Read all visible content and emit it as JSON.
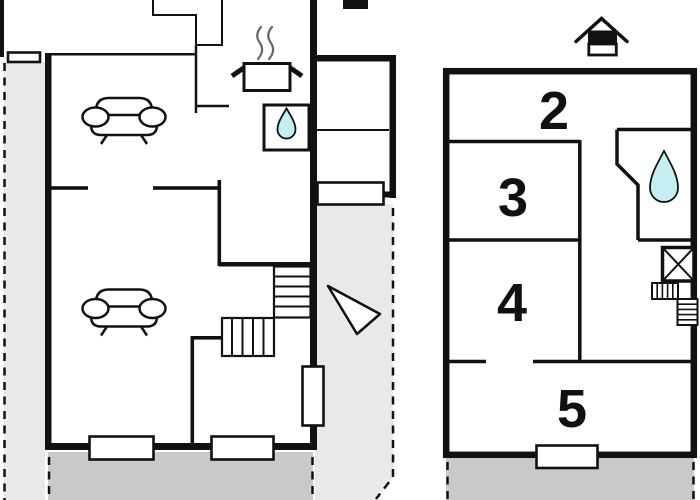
{
  "title": "Two-storey holiday home floor plan",
  "colors": {
    "wall": "#111111",
    "terrace_light": "#e9e9e9",
    "terrace_dark": "#c9c9c9",
    "water_drop": "#c5eef2",
    "steam": "#666666",
    "background": "#ffffff"
  },
  "floors": {
    "ground": {
      "name": "ground floor",
      "icons": [
        "sofa-icon",
        "sofa-icon",
        "stove-pot-icon",
        "steam-icon",
        "sink-icon",
        "water-drop-icon",
        "staircase-icon",
        "north-arrow-icon",
        "chimney-icon"
      ],
      "window_count": 4,
      "door_count": 1
    },
    "upper": {
      "name": "upper floor",
      "rooms": [
        {
          "label": "2"
        },
        {
          "label": "3"
        },
        {
          "label": "4"
        },
        {
          "label": "5"
        }
      ],
      "icons": [
        "water-drop-icon",
        "shower-icon",
        "staircase-icon",
        "house-marker-icon"
      ],
      "window_count": 1
    }
  }
}
